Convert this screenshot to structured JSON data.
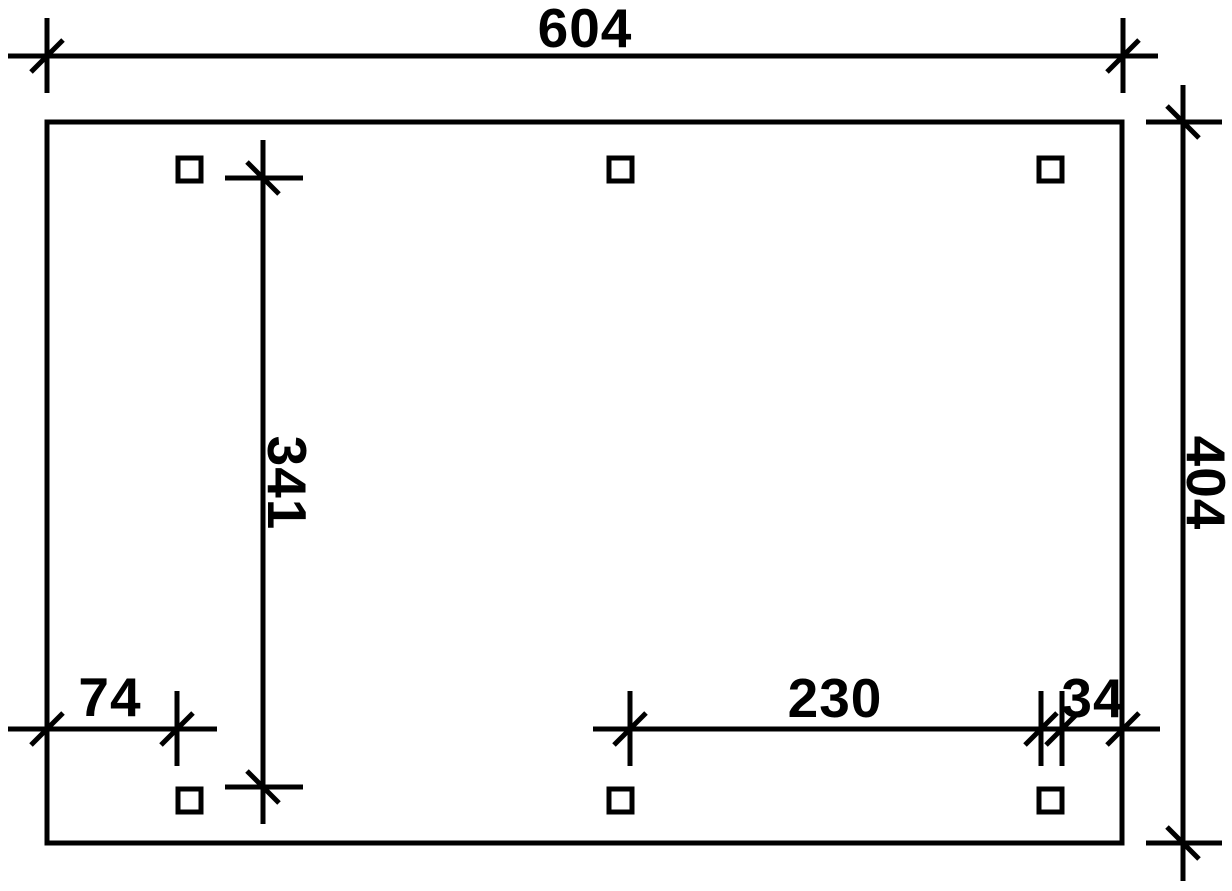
{
  "drawing": {
    "ink_color": "#000000",
    "paper_color": "#ffffff",
    "dim_labels": {
      "top_width": "604",
      "right_height": "404",
      "inner_height": "341",
      "bottom_left_offset": "74",
      "bottom_post_spacing": "230",
      "bottom_right_offset": "34"
    }
  }
}
